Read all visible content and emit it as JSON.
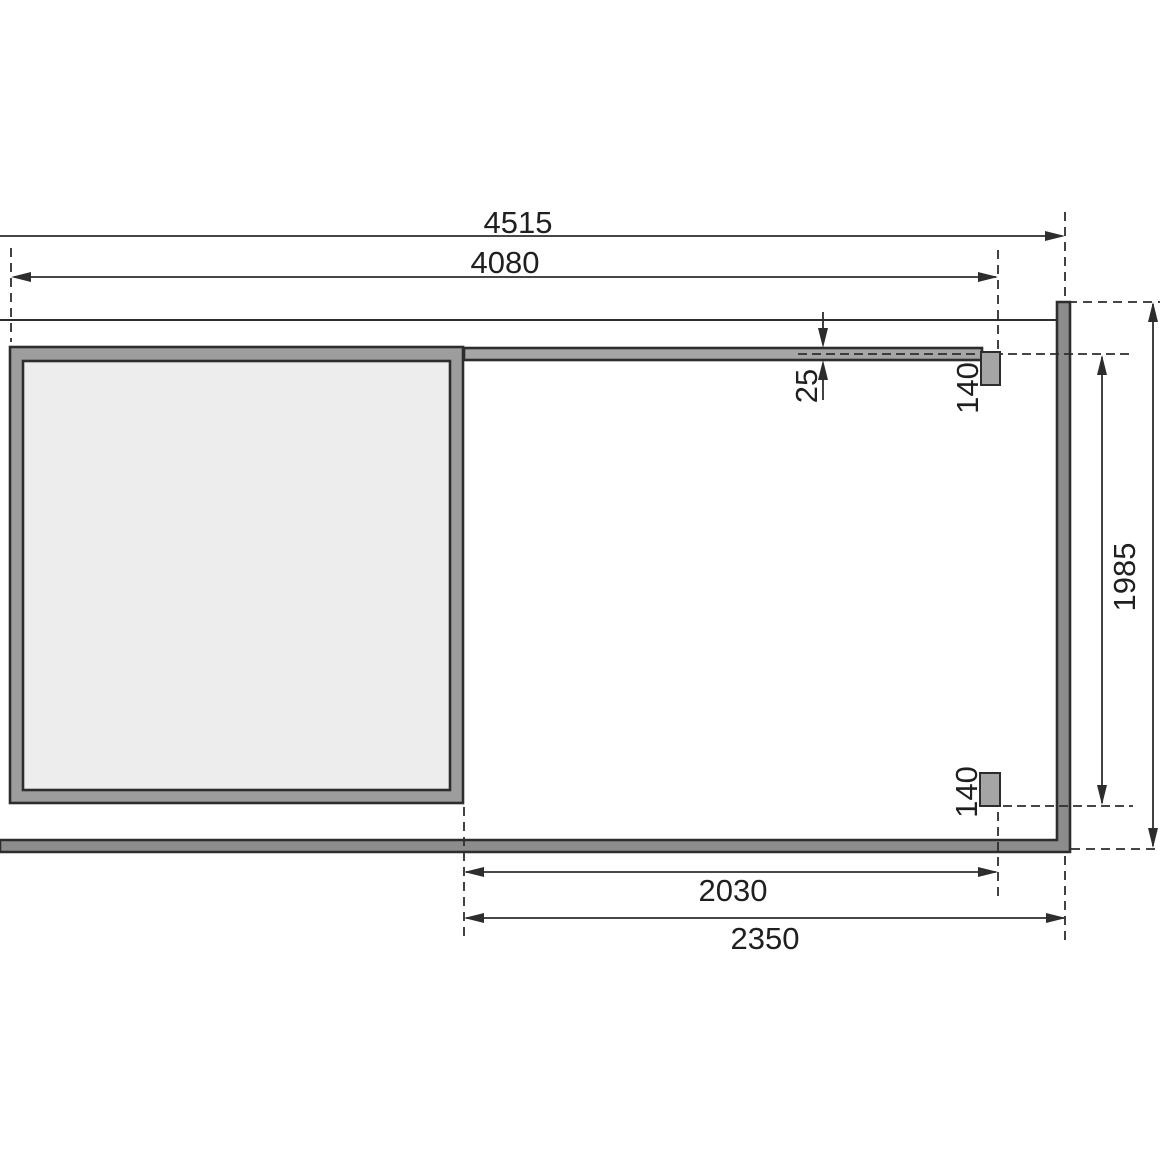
{
  "dimensions": {
    "d4515": "4515",
    "d4080": "4080",
    "d25": "25",
    "d140_front": "140",
    "d140_back": "140",
    "d1985": "1985",
    "d2030": "2030",
    "d2350": "2350"
  },
  "colors": {
    "background": "#ffffff",
    "line": "#2d2d2d",
    "text": "#1f1f1f",
    "wall_fill": "#9d9d9d",
    "interior_fill": "#ededed",
    "beam_fill": "#a6a6a6",
    "frame_fill": "#8c8c8c",
    "post_fill": "#a5a5a5"
  }
}
